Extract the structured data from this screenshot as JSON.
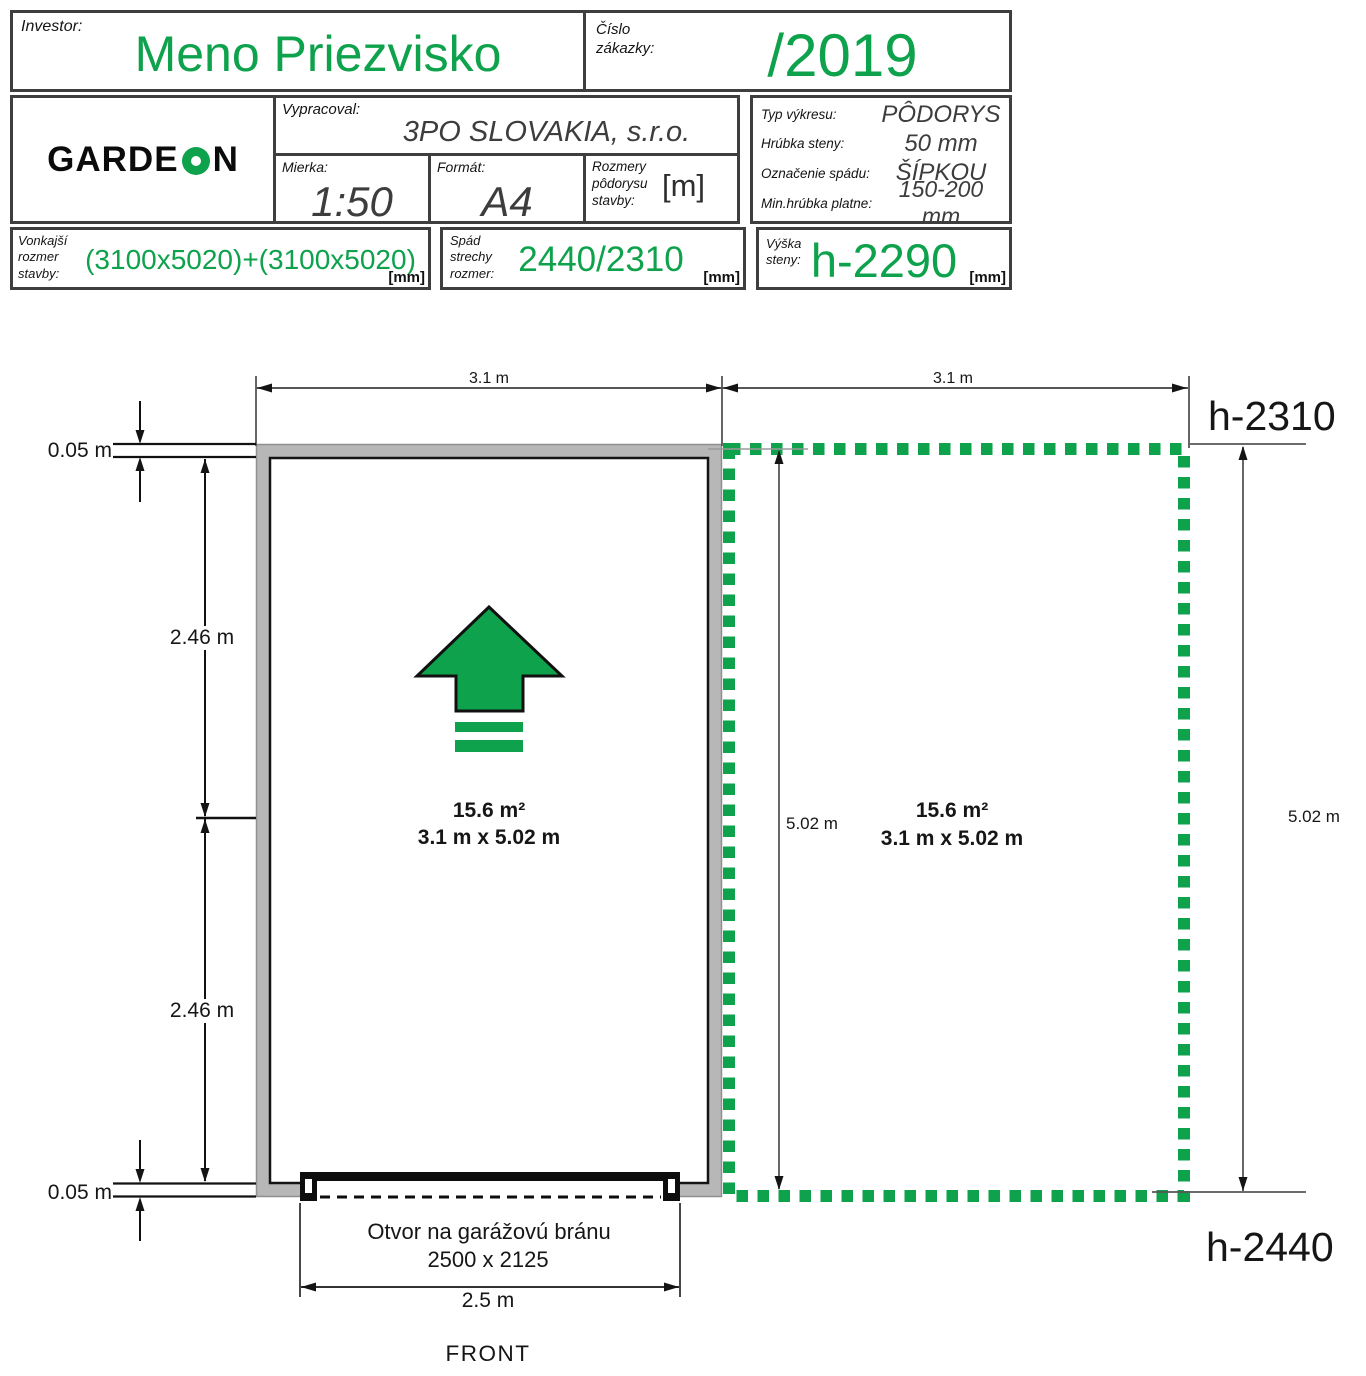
{
  "colors": {
    "accent_green": "#0ea24c",
    "wall_gray": "#b7b7b7"
  },
  "title_block": {
    "investor": {
      "label": "Investor:",
      "value": "Meno Priezvisko"
    },
    "order": {
      "label": "Číslo zákazky:",
      "value": "/2019"
    },
    "logo": {
      "text_before": "GARDE",
      "text_after": "N"
    },
    "prepared_by": {
      "label": "Vypracoval:",
      "value": "3PO SLOVAKIA, s.r.o."
    },
    "scale": {
      "label": "Mierka:",
      "value": "1:50"
    },
    "format": {
      "label": "Formát:",
      "value": "A4"
    },
    "plan_dims": {
      "label": "Rozmery pôdorysu stavby:",
      "unit": "[m]"
    },
    "drawing_type": {
      "label": "Typ výkresu:",
      "value": "PÔDORYS"
    },
    "wall_thickness": {
      "label": "Hrúbka steny:",
      "value": "50 mm"
    },
    "slope_marking": {
      "label": "Označenie spádu:",
      "value": "ŠÍPKOU"
    },
    "min_plate": {
      "label": "Min.hrúbka platne:",
      "value": "150-200 mm"
    },
    "outer_size": {
      "label": "Vonkajší rozmer stavby:",
      "value": "(3100x5020)+(3100x5020)",
      "unit": "[mm]"
    },
    "roof_slope": {
      "label": "Spád strechy rozmer:",
      "value": "2440/2310",
      "unit": "[mm]"
    },
    "wall_height": {
      "label": "Výška steny:",
      "value": "h-2290",
      "unit": "[mm]"
    }
  },
  "plan": {
    "top_dim_left": "3.1 m",
    "top_dim_right": "3.1 m",
    "height_top": "h-2310",
    "height_bottom": "h-2440",
    "wall_dim_top": "0.05 m",
    "wall_dim_bottom": "0.05 m",
    "side_dim_upper": "2.46 m",
    "side_dim_lower": "2.46 m",
    "depth_dim_inner": "5.02 m",
    "depth_dim_right": "5.02 m",
    "left_unit": {
      "area": "15.6 m²",
      "size": "3.1 m x 5.02 m"
    },
    "right_unit": {
      "area": "15.6 m²",
      "size": "3.1 m x 5.02 m"
    },
    "door": {
      "label": "Otvor na garážovú bránu",
      "size": "2500 x 2125",
      "dim": "2.5 m"
    },
    "front_label": "FRONT"
  }
}
